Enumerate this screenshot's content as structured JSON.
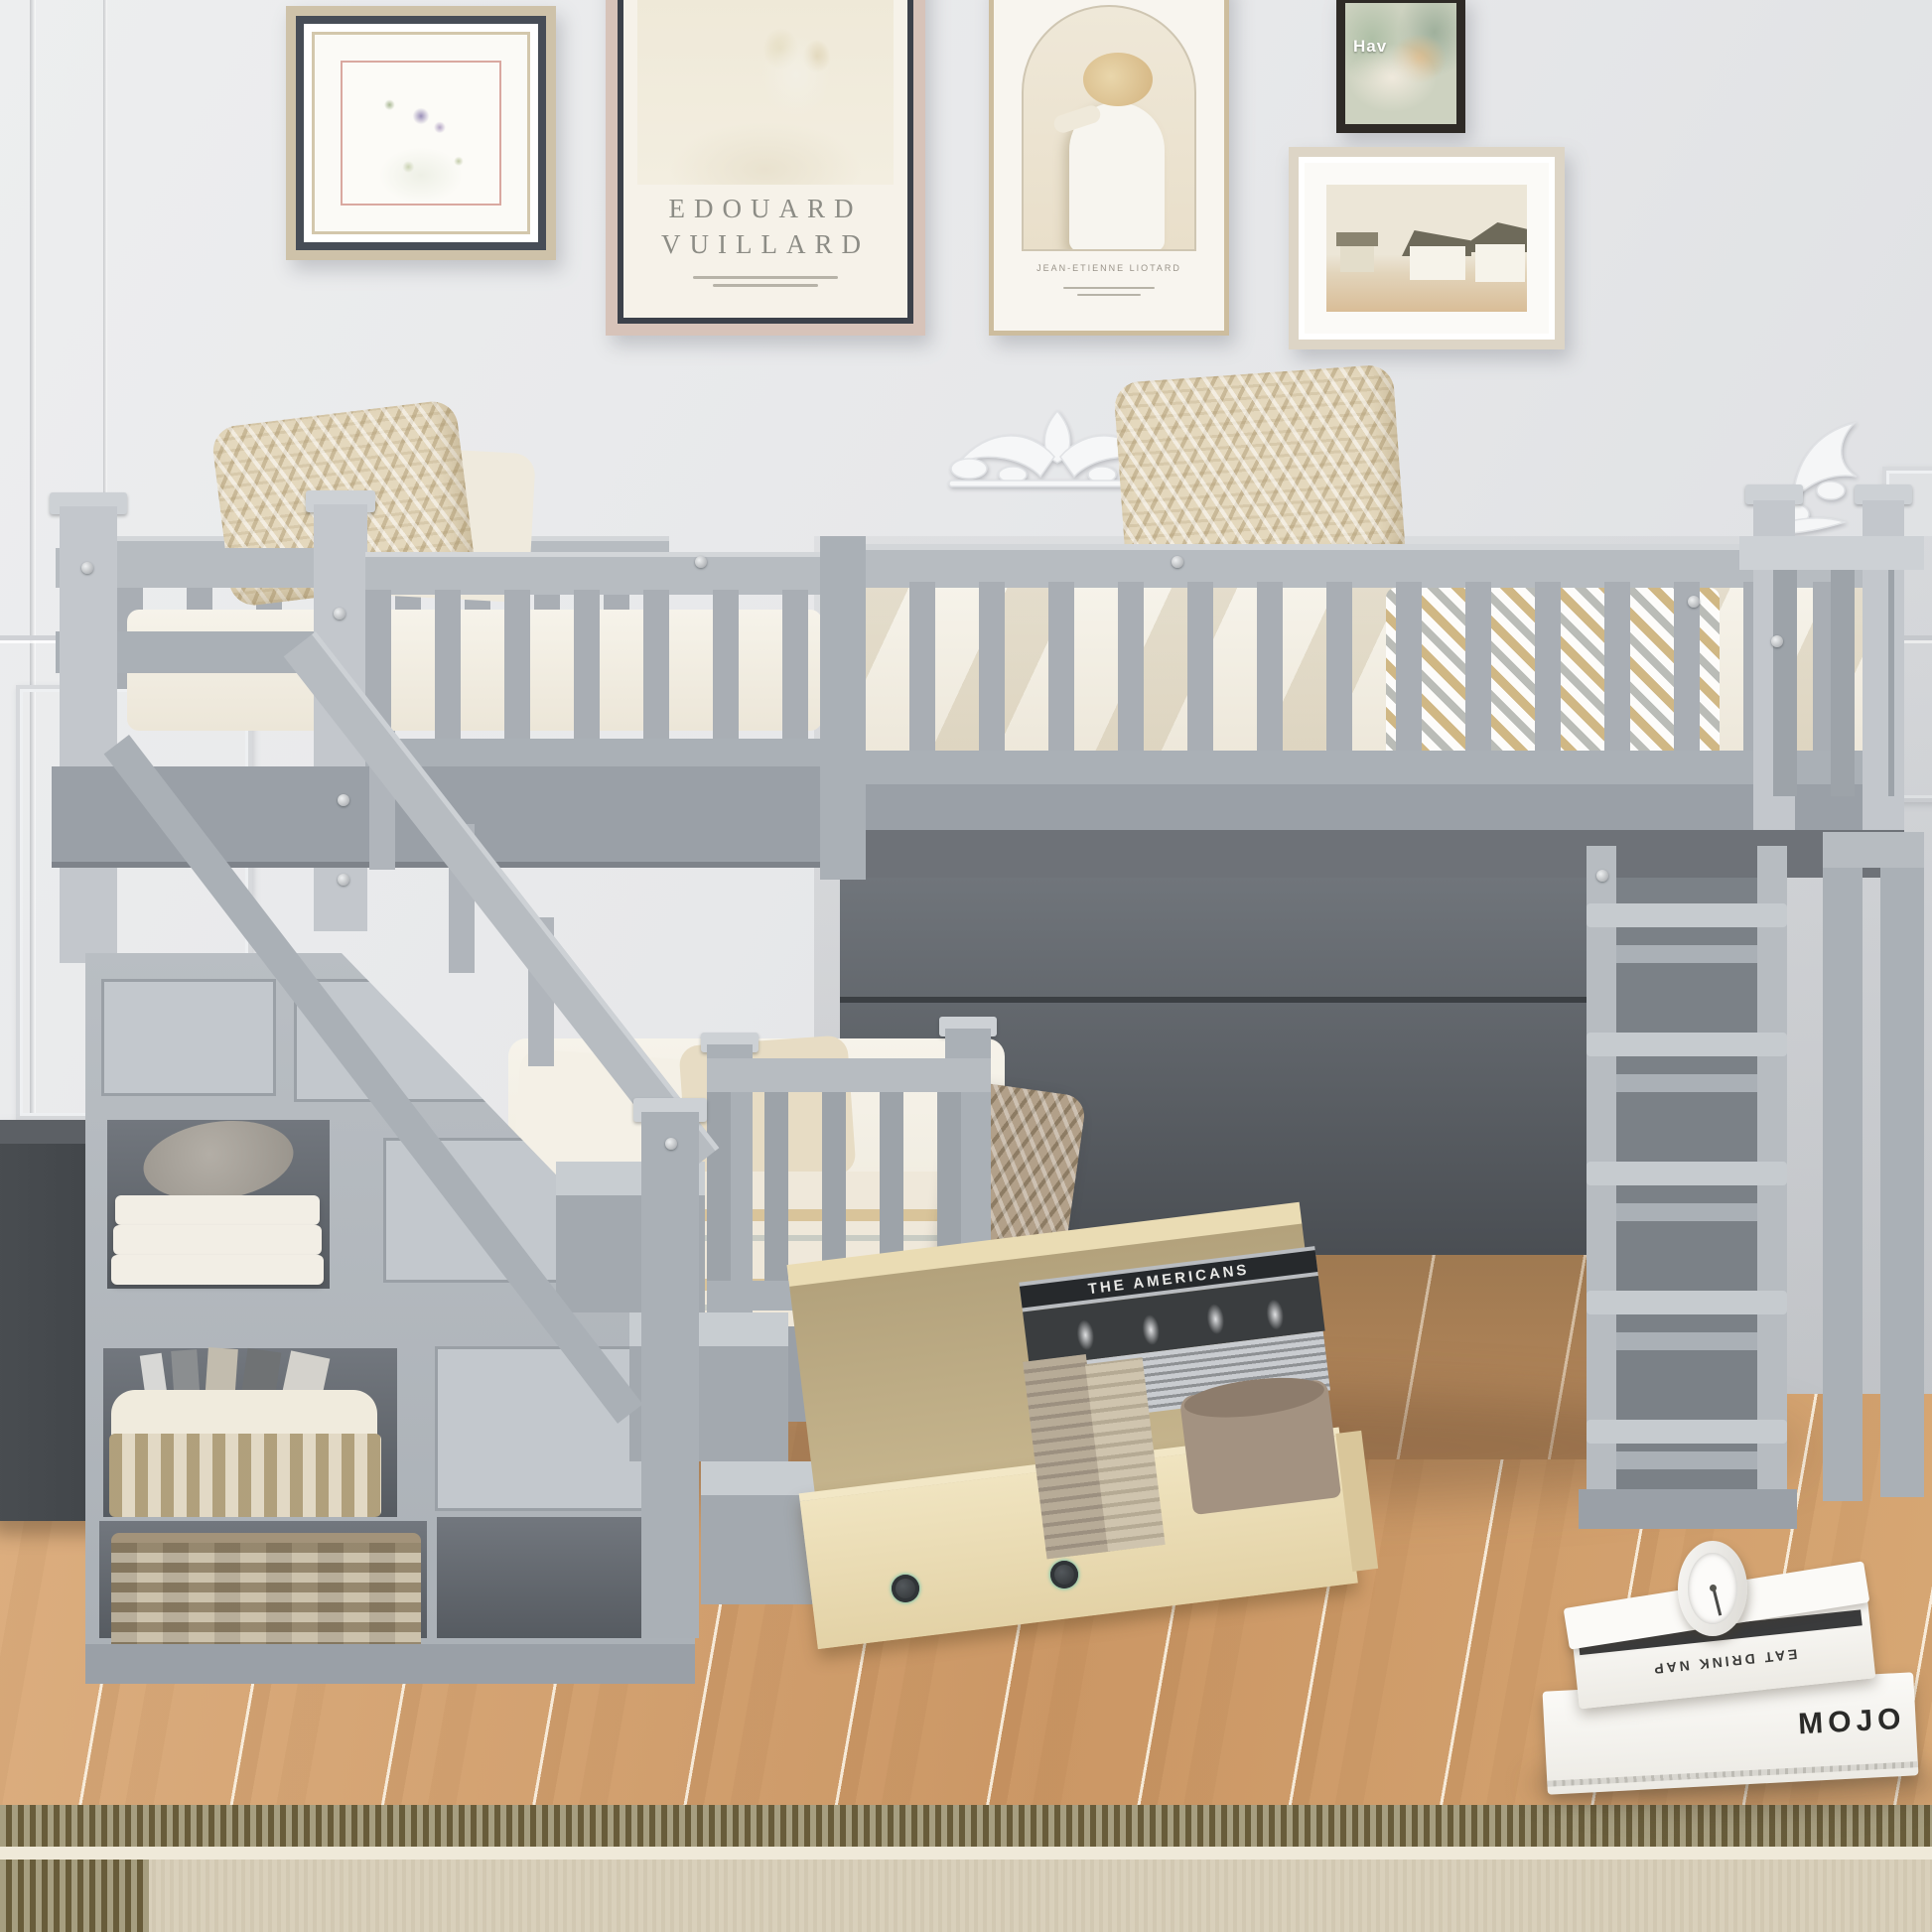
{
  "scene": {
    "description": "Gray wooden L-shaped twin-over-twin loft bunk bed with storage staircase, shelving tower, ladder and rolling under-bed drawer in a bright bedroom with gallery wall, wood floor and woven rug"
  },
  "gallery": {
    "frame_botanical": {
      "name": "botanical-toile-print"
    },
    "frame_poster": {
      "line1": "EDOUARD",
      "line2": "VUILLARD"
    },
    "frame_portrait": {
      "caption": "JEAN-ETIENNE LIOTARD"
    },
    "frame_cat": {
      "overlay_text": "Hav"
    },
    "frame_landscape": {
      "name": "village-watercolor"
    }
  },
  "storage": {
    "drawer_book_title": "THE AMERICANS"
  },
  "floor_stack": {
    "top_book_spine": "EAT DRINK NAP",
    "bottom_book_spine": "MOJO",
    "clock": "analog-clock"
  },
  "palette": {
    "wall": "#e7e8ea",
    "bed_gray": "#aab0b6",
    "bed_gray_light": "#c3c7cc",
    "bed_gray_dark": "#878c93",
    "under_bed_panel": "#4e5257",
    "bedding": "#f3efe6",
    "pillow_knit": "#e4d8bd",
    "floor_wood": "#cb9765",
    "rug_border": "#80744f",
    "rug_field": "#d9d0bb",
    "drawer_wood": "#e3d2a6",
    "caster_teal": "#3fbfae"
  }
}
